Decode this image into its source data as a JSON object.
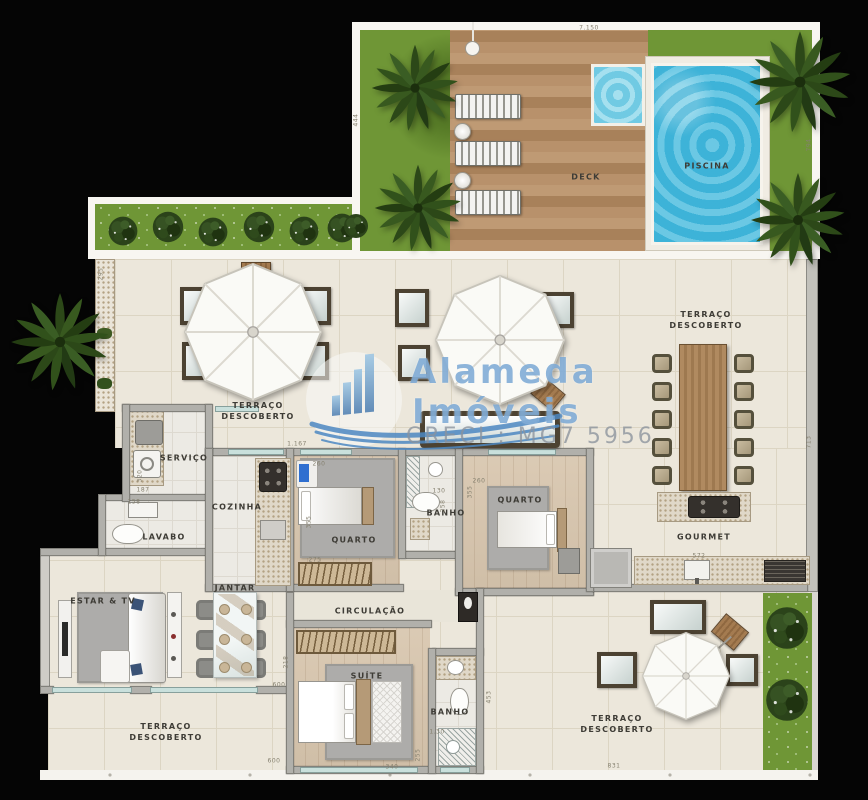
{
  "plan": {
    "watermark": {
      "brand_line1": "Alameda",
      "brand_line2": "Imóveis",
      "creci": "CRECI : MG7 5956"
    },
    "room_labels": [
      {
        "id": "piscina",
        "lines": [
          "PISCINA"
        ],
        "x": 707,
        "y": 166
      },
      {
        "id": "deck",
        "lines": [
          "DECK"
        ],
        "x": 586,
        "y": 177
      },
      {
        "id": "terraco-descoberto-esq",
        "lines": [
          "TERRAÇO",
          "DESCOBERTO"
        ],
        "x": 258,
        "y": 411
      },
      {
        "id": "terraco-descoberto-dir",
        "lines": [
          "TERRAÇO",
          "DESCOBERTO"
        ],
        "x": 706,
        "y": 320
      },
      {
        "id": "servico",
        "lines": [
          "SERVIÇO"
        ],
        "x": 184,
        "y": 458
      },
      {
        "id": "cozinha",
        "lines": [
          "COZINHA"
        ],
        "x": 237,
        "y": 507
      },
      {
        "id": "lavabo",
        "lines": [
          "LAVABO"
        ],
        "x": 164,
        "y": 537
      },
      {
        "id": "quarto-1",
        "lines": [
          "QUARTO"
        ],
        "x": 354,
        "y": 540
      },
      {
        "id": "banho-1",
        "lines": [
          "BANHO"
        ],
        "x": 446,
        "y": 513
      },
      {
        "id": "quarto-2",
        "lines": [
          "QUARTO"
        ],
        "x": 520,
        "y": 500
      },
      {
        "id": "gourmet",
        "lines": [
          "GOURMET"
        ],
        "x": 704,
        "y": 537
      },
      {
        "id": "jantar",
        "lines": [
          "JANTAR"
        ],
        "x": 235,
        "y": 588
      },
      {
        "id": "estar-tv",
        "lines": [
          "ESTAR & TV"
        ],
        "x": 103,
        "y": 601
      },
      {
        "id": "circulacao",
        "lines": [
          "CIRCULAÇÃO"
        ],
        "x": 370,
        "y": 611
      },
      {
        "id": "suite",
        "lines": [
          "SUÍTE"
        ],
        "x": 367,
        "y": 676
      },
      {
        "id": "banho-suite",
        "lines": [
          "BANHO"
        ],
        "x": 450,
        "y": 712
      },
      {
        "id": "terraco-descoberto-inf-esq",
        "lines": [
          "TERRAÇO",
          "DESCOBERTO"
        ],
        "x": 166,
        "y": 732
      },
      {
        "id": "terraco-descoberto-inf-dir",
        "lines": [
          "TERRAÇO",
          "DESCOBERTO"
        ],
        "x": 617,
        "y": 724
      }
    ],
    "dimensions": [
      {
        "t": "7.150",
        "x": 589,
        "y": 28
      },
      {
        "t": "444",
        "x": 356,
        "y": 120,
        "v": 1
      },
      {
        "t": "794",
        "x": 809,
        "y": 145,
        "v": 1
      },
      {
        "t": "295",
        "x": 101,
        "y": 274,
        "v": 1
      },
      {
        "t": "320",
        "x": 140,
        "y": 476,
        "v": 1
      },
      {
        "t": "187",
        "x": 143,
        "y": 490
      },
      {
        "t": "158",
        "x": 134,
        "y": 502
      },
      {
        "t": "1.167",
        "x": 297,
        "y": 444
      },
      {
        "t": "260",
        "x": 319,
        "y": 464
      },
      {
        "t": "355",
        "x": 309,
        "y": 522,
        "v": 1
      },
      {
        "t": "275",
        "x": 315,
        "y": 560
      },
      {
        "t": "130",
        "x": 439,
        "y": 491
      },
      {
        "t": "258",
        "x": 443,
        "y": 506,
        "v": 1
      },
      {
        "t": "260",
        "x": 479,
        "y": 481
      },
      {
        "t": "355",
        "x": 470,
        "y": 492,
        "v": 1
      },
      {
        "t": "713",
        "x": 809,
        "y": 442,
        "v": 1
      },
      {
        "t": "572",
        "x": 699,
        "y": 556
      },
      {
        "t": "600",
        "x": 279,
        "y": 685
      },
      {
        "t": "218",
        "x": 286,
        "y": 662,
        "v": 1
      },
      {
        "t": "340",
        "x": 392,
        "y": 767
      },
      {
        "t": "255",
        "x": 418,
        "y": 755,
        "v": 1
      },
      {
        "t": "453",
        "x": 489,
        "y": 697,
        "v": 1
      },
      {
        "t": "1.30",
        "x": 437,
        "y": 732
      },
      {
        "t": "831",
        "x": 614,
        "y": 766
      },
      {
        "t": "600",
        "x": 274,
        "y": 761
      }
    ],
    "colors": {
      "grass": "#6f9636",
      "deck_wood": "#b48f69",
      "pool_water": "#41b9dd",
      "kiddie_water": "#7ed3e8",
      "floor_tile": "#ece7db",
      "interior_wood": "#d8c6ae",
      "wall_gray": "#b1b0ab",
      "glass_teal": "#c9e0dc",
      "watermark_blue": "#74a3d2",
      "label_dark": "#3e3c36"
    }
  }
}
